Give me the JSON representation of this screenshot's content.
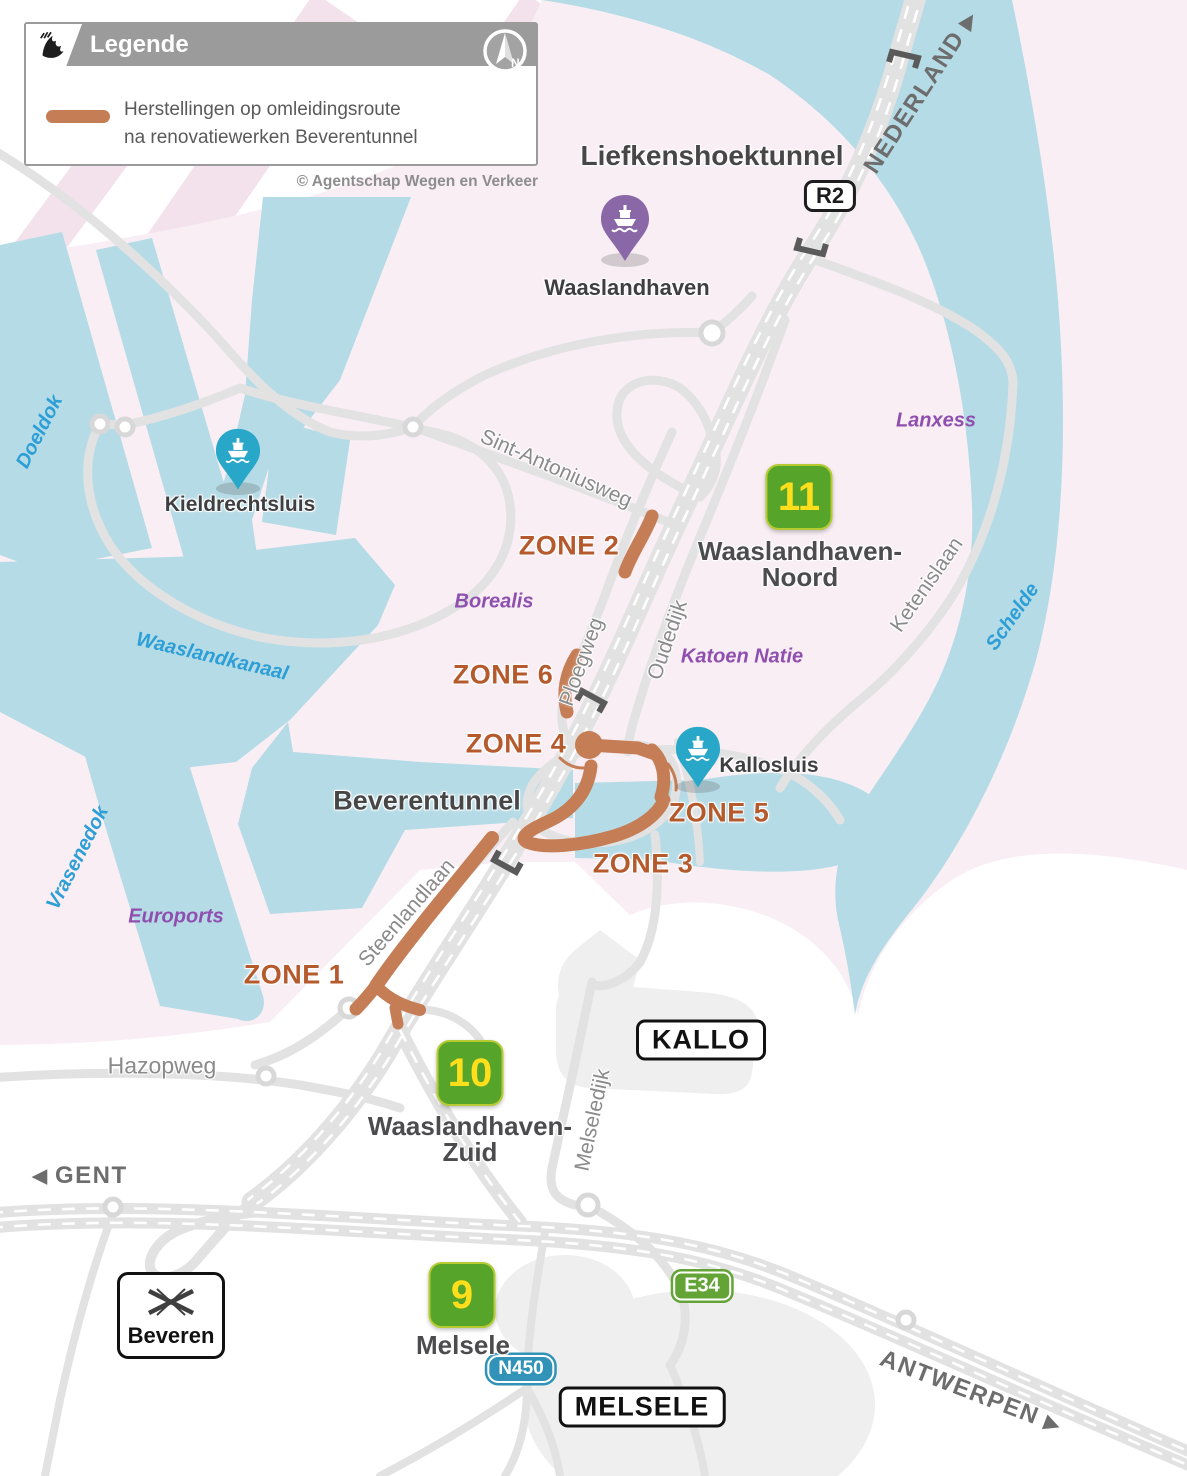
{
  "colors": {
    "water": "#b5dbe6",
    "land-pink": "#f8eef4",
    "stripe-pink": "#f3e2ec",
    "road": "#e2e2e2",
    "node-ring": "#d8d8d8",
    "built-area": "#efefef",
    "zone-orange": "#c57d55",
    "zone-label": "#b45a2d",
    "badge-green": "#57a42a",
    "badge-border": "#b5cb31",
    "badge-number": "#ffdf1b",
    "e34-green": "#64a437",
    "n450-blue": "#3093b7",
    "pin-teal": "#29a7c8",
    "pin-purple": "#8a67a7",
    "water-label": "#2d9fd6",
    "company-label": "#8f4fae",
    "dark-text": "#474747",
    "road-label": "#8a8a8a",
    "direction-label": "#6d6d6d",
    "tunnel-bracket": "#5a5a5a"
  },
  "legend": {
    "title": "Legende",
    "item_line1": "Herstellingen op omleidingsroute",
    "item_line2": "na renovatiewerken Beverentunnel"
  },
  "copyright": "© Agentschap Wegen en Verkeer",
  "compass": {
    "letter": "N"
  },
  "icons": {
    "arrow_left": "◀",
    "arrow_right": "▶"
  },
  "directions": {
    "nederland": "NEDERLAND",
    "gent": "GENT",
    "antwerpen": "ANTWERPEN"
  },
  "tunnels": {
    "liefkenshoek": "Liefkenshoektunnel",
    "beveren": "Beverentunnel"
  },
  "road_badges": {
    "r2": "R2",
    "e34": "E34",
    "n450": "N450"
  },
  "place_signs": {
    "kallo": "KALLO",
    "melsele": "MELSELE",
    "beveren": "Beveren"
  },
  "exits": {
    "e11": {
      "number": "11",
      "line1": "Waaslandhaven-",
      "line2": "Noord"
    },
    "e10": {
      "number": "10",
      "line1": "Waaslandhaven-",
      "line2": "Zuid"
    },
    "e9": {
      "number": "9",
      "line1": "Melsele",
      "line2": ""
    }
  },
  "zones": {
    "z1": "ZONE 1",
    "z2": "ZONE 2",
    "z3": "ZONE 3",
    "z4": "ZONE 4",
    "z5": "ZONE 5",
    "z6": "ZONE 6"
  },
  "pins": {
    "waaslandhaven": "Waaslandhaven",
    "kieldrechtsluis": "Kieldrechtsluis",
    "kallosluis": "Kallosluis"
  },
  "waters": {
    "doeldok": "Doeldok",
    "waaslandkanaal": "Waaslandkanaal",
    "vrasenedok": "Vrasenedok",
    "schelde": "Schelde"
  },
  "companies": {
    "lanxess": "Lanxess",
    "borealis": "Borealis",
    "katoen_natie": "Katoen Natie",
    "euroports": "Euroports"
  },
  "roads": {
    "sint_antoniusweg": "Sint-Antoniusweg",
    "ploegweg": "Ploegweg",
    "oudedijk": "Oudedijk",
    "ketenislaan": "Ketenislaan",
    "steenlandlaan": "Steenlandlaan",
    "hazopweg": "Hazopweg",
    "melseledijk": "Melseledijk"
  }
}
